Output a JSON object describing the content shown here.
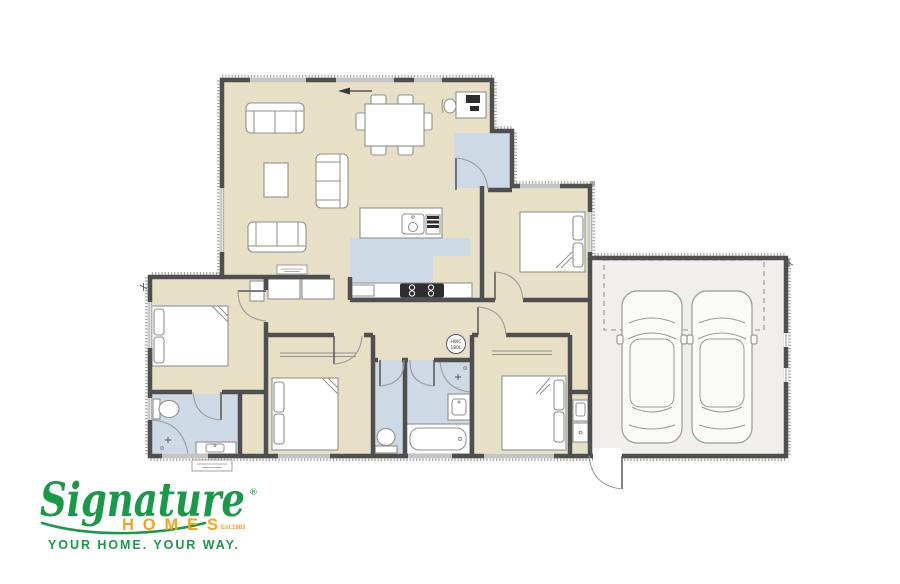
{
  "page": {
    "background": "#ffffff"
  },
  "colors": {
    "room_fill": "#e8e0c6",
    "wet_fill": "#cdd9e4",
    "garage_fill": "#f0efec",
    "wall": "#4f4f4f",
    "furniture": "#8f8f8f",
    "hatch": "#b0aca4",
    "logo_green": "#189a4a",
    "logo_orange": "#f0a31d"
  },
  "plan": {
    "hwc": {
      "line1": "HWC",
      "line2": "180L"
    }
  },
  "logo": {
    "brand": "Signature",
    "registered": "®",
    "homes": "HOMES",
    "est": "Est.1983",
    "tagline": "YOUR HOME.  YOUR WAY."
  }
}
